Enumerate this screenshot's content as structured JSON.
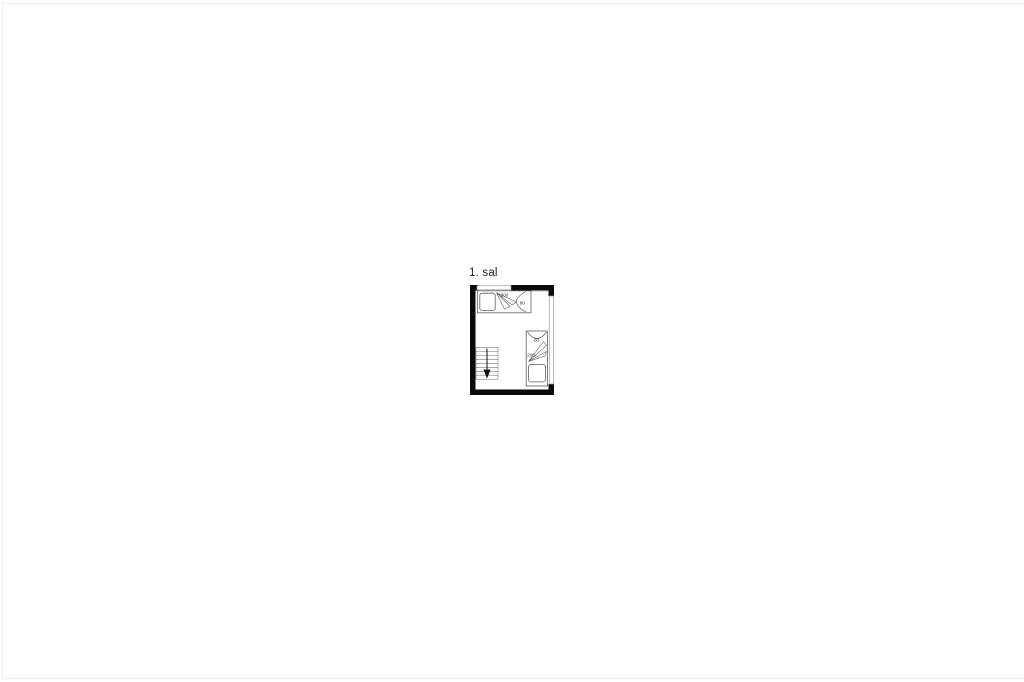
{
  "plan": {
    "title": "1. sal",
    "bed_top": {
      "length_label": "200",
      "width_label": "80"
    },
    "bed_right": {
      "width_label": "80",
      "length_label": "200"
    },
    "stairs": {
      "direction": "down"
    },
    "colors": {
      "wall": "#0a0a0a",
      "window_line": "#9a9a9a",
      "furniture_line": "#5f5f5f",
      "label_text": "#333333",
      "page_border": "#ececec"
    }
  }
}
